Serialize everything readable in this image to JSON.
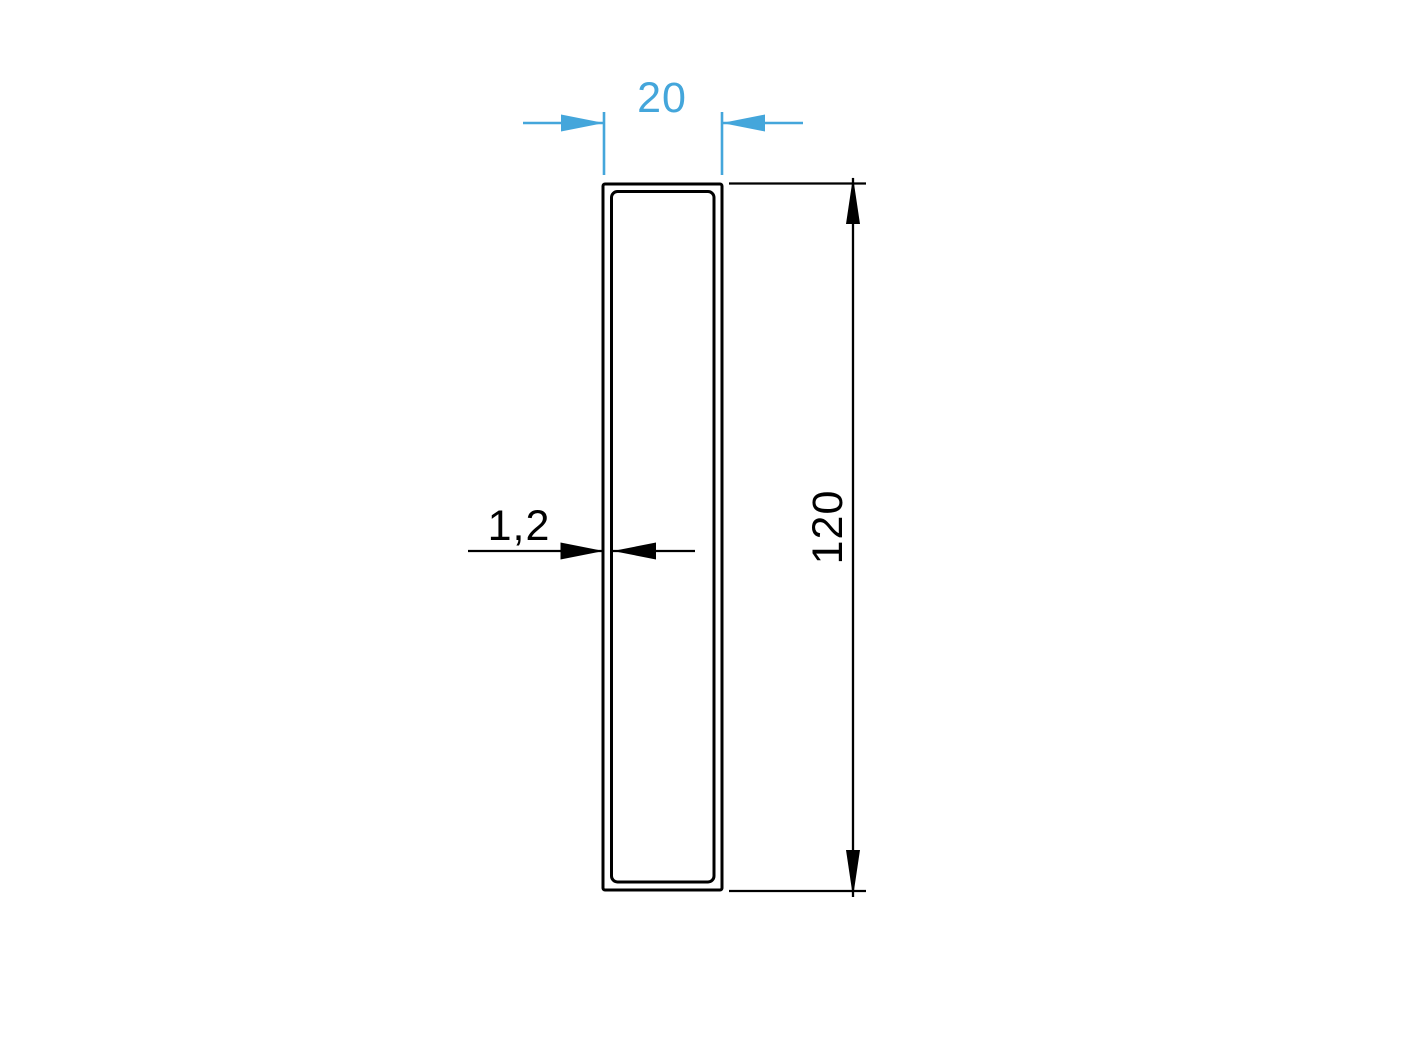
{
  "colors": {
    "accent": "#44a6db",
    "line": "#000000",
    "background": "#ffffff"
  },
  "drawing": {
    "dimensions": {
      "width": {
        "label": "20"
      },
      "height": {
        "label": "120"
      },
      "wall_thickness": {
        "label": "1,2"
      }
    }
  }
}
